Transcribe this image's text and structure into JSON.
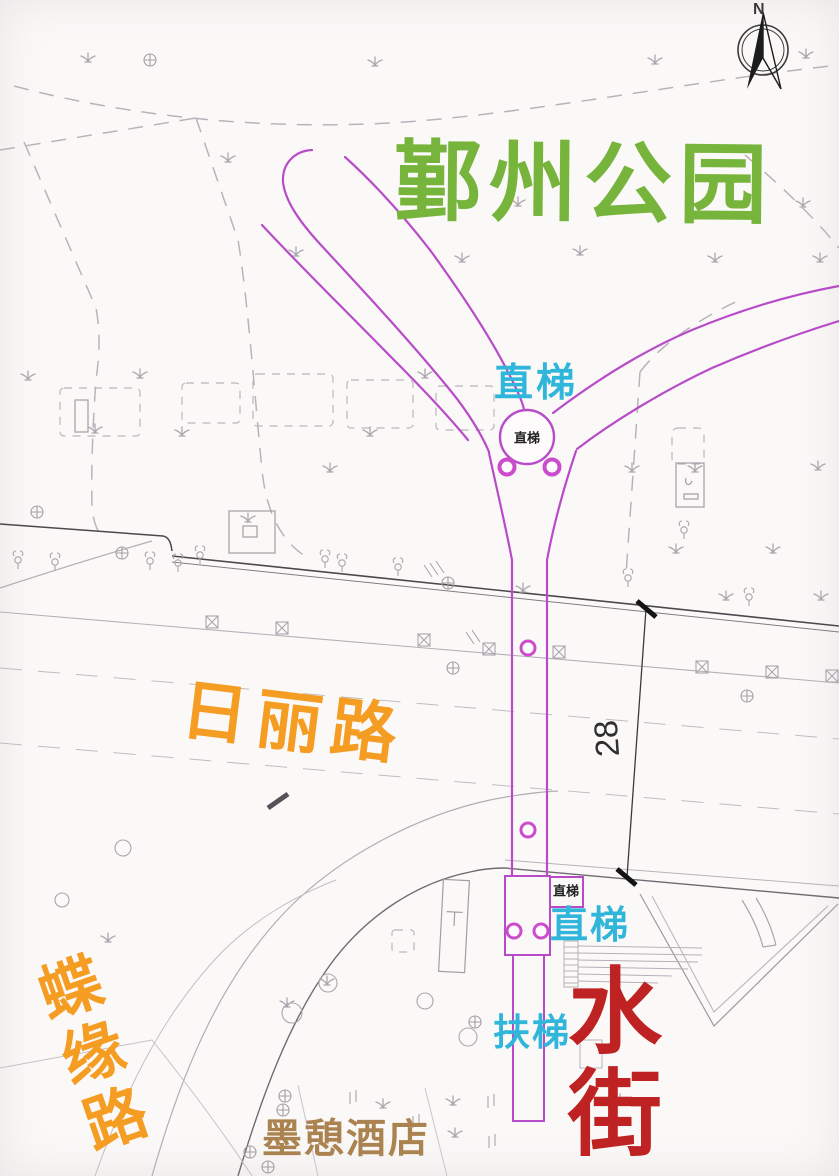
{
  "compass": {
    "north": "N"
  },
  "park": {
    "name": "鄞州公园"
  },
  "roads": {
    "rili_road": "日丽路",
    "dieyuan_road": "蝶缘路"
  },
  "places": {
    "water_street": "水街",
    "hotel": "墨憩酒店"
  },
  "facilities": {
    "elevator_top_label": "直梯",
    "elevator_top_marker": "直梯",
    "elevator_bottom_marker": "直梯",
    "elevator_bottom_label": "直梯",
    "escalator_label": "扶梯"
  },
  "dimension": {
    "road_width": "28"
  },
  "colors": {
    "park_green": "#77b43c",
    "facility_cyan": "#2fb6da",
    "road_orange": "#f59c23",
    "destination_red": "#bf2222",
    "hotel_brown": "#aa8350",
    "path_magenta": "#b84cc8",
    "ring_magenta": "#cb4ccc",
    "cad_light": "#b5b0b8",
    "cad_dark": "#4b484e",
    "background": "#fbf9f8"
  }
}
